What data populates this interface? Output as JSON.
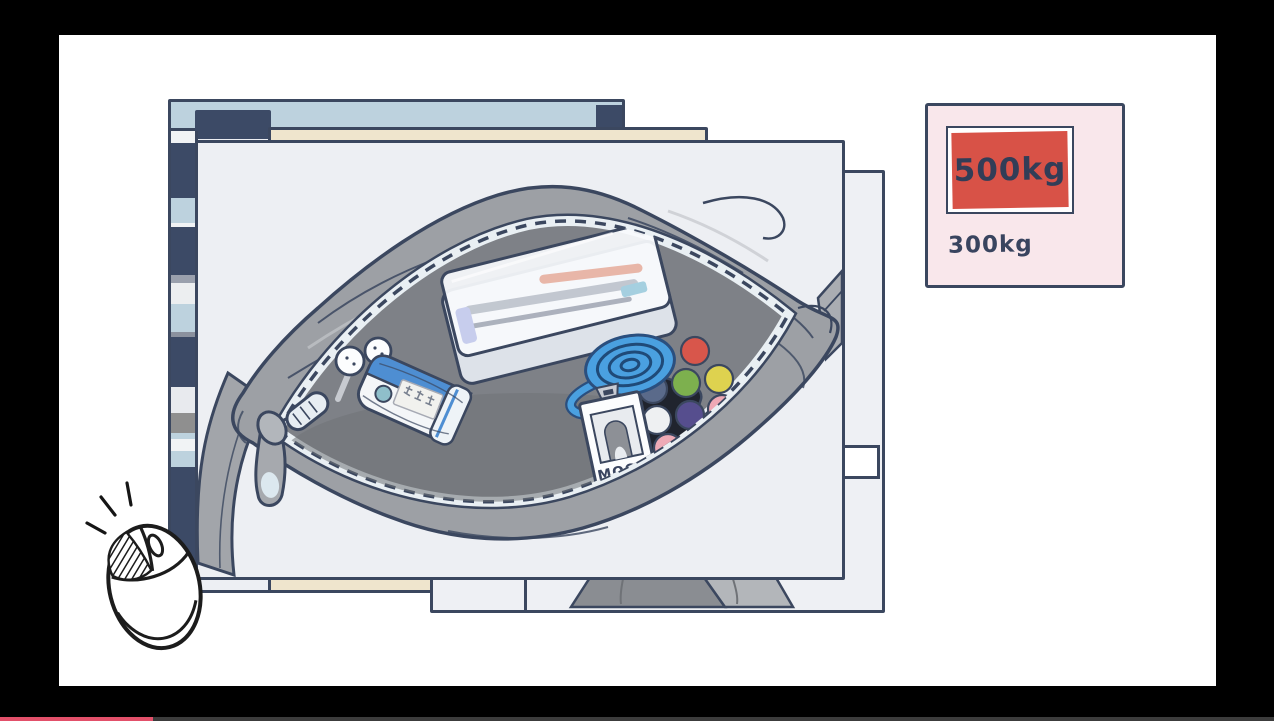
{
  "scene": {
    "description": "Hand-drawn illustration: stacked photos of an open gray duffel bag full of items, a luggage weight card, and a clicking mouse hint, shown in a letterboxed video player",
    "canvas_bg": "#ffffff",
    "letterbox_bg": "#000000",
    "outline_color": "#3b475f"
  },
  "weight_card": {
    "bg": "#f9e7eb",
    "highlight_bg": "#d85247",
    "highlight_label": "500kg",
    "secondary_label": "300kg"
  },
  "badge": {
    "label": "MOON"
  },
  "bag": {
    "body_color": "#9da0a5",
    "interior_color": "#7e8187",
    "items": [
      "pencil-case",
      "earbuds",
      "stamp-case",
      "heart-gift-box",
      "id-badge",
      "candy-balls",
      "coiled-lanyard",
      "black-pouch",
      "zipper-slider"
    ]
  },
  "photos": {
    "back_app_header_color": "#bdd2de",
    "back_app_tab_color": "#3c4a66",
    "cream_photo_color": "#efe5cd",
    "paper_color": "#edeff3"
  },
  "mouse_hint": {
    "button_pressed": "left"
  },
  "player": {
    "progress_percent": 12,
    "progress_color": "#e2506a",
    "track_color": "#3c3c3c"
  }
}
